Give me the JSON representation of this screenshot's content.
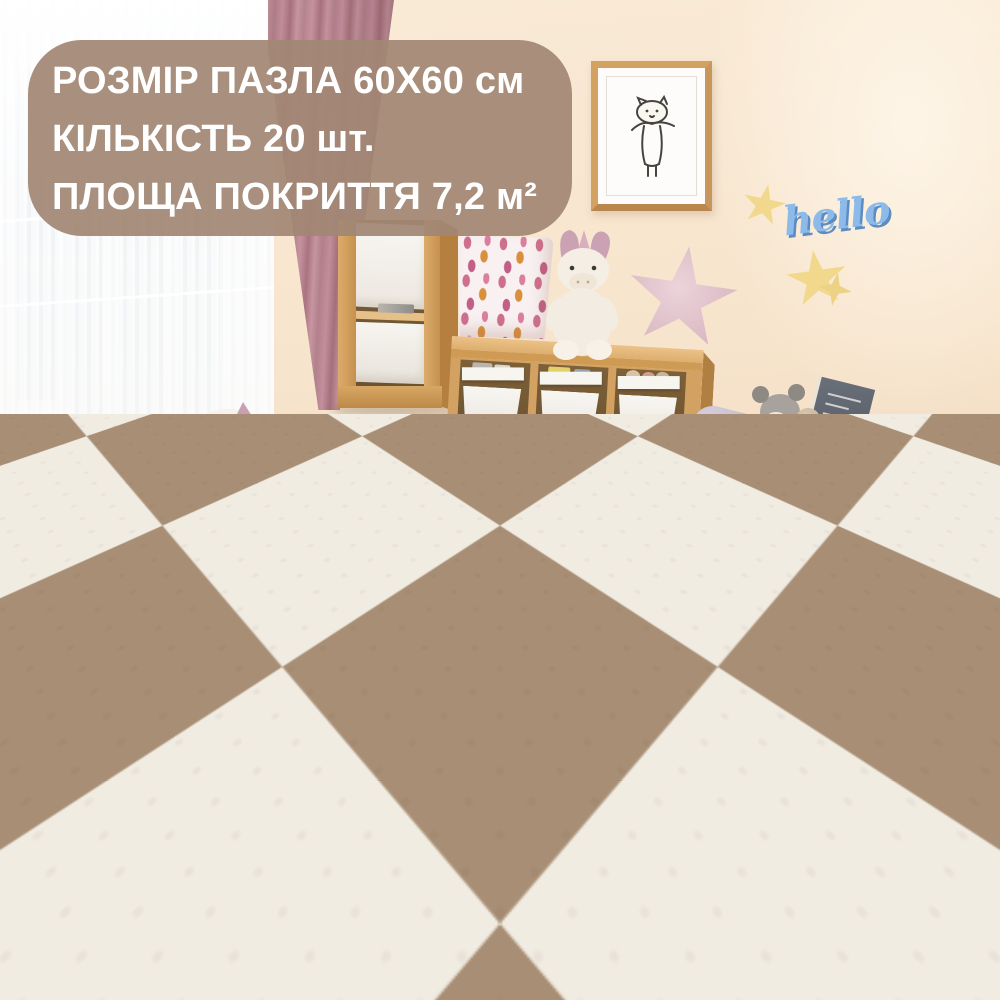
{
  "overlay_badge": {
    "background_color": "rgba(161,134,116,0.93)",
    "text_color": "#ffffff",
    "lines": [
      "РОЗМІР ПАЗЛА 60Х60 см",
      "КІЛЬКІСТЬ 20 шт.",
      "ПЛОЩА ПОКРИТТЯ 7,2 м²"
    ]
  },
  "wall_decor": {
    "hello_sign": {
      "text": "hello",
      "color": "#8cbbea"
    },
    "star_color": "#f2d88c",
    "frame_art": "cat-doodle"
  },
  "toy_basket": {
    "label": "TOYS",
    "label_color": "#332f2c"
  },
  "scene": {
    "description": "children playroom with interlocking foam puzzle play mats laid in a diagonal checkerboard",
    "mat_color_light": "#f1ece2",
    "mat_color_dark": "#a78e74",
    "wall_color": "#f7e7d1",
    "wood_color": "#d3a263",
    "curtain_color": "#c2919b"
  }
}
